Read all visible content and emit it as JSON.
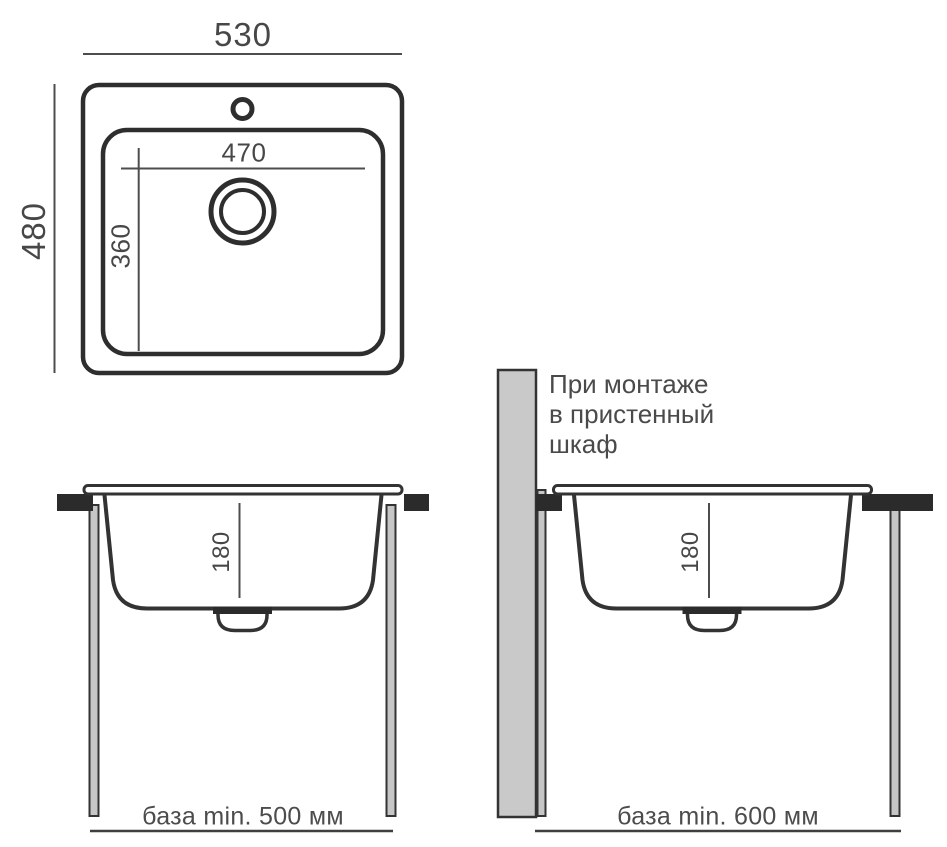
{
  "top_view": {
    "outer_width_label": "530",
    "outer_depth_label": "480",
    "bowl_width_label": "470",
    "bowl_depth_label": "360"
  },
  "side_view_left": {
    "bowl_height_label": "180",
    "base_label": "база min. 500 мм"
  },
  "side_view_right": {
    "bowl_height_label": "180",
    "base_label": "база min. 600 мм",
    "wall_note": {
      "lines": [
        "При монтаже",
        "в пристенный",
        "шкаф"
      ]
    }
  },
  "colors": {
    "line": "#333333",
    "dim_line": "#4d4d4d",
    "countertop": "#2b2b2b",
    "panel_fill": "#c9c9c9",
    "leg_fill": "#c6c6c6",
    "text": "#474747",
    "background": "#ffffff"
  }
}
